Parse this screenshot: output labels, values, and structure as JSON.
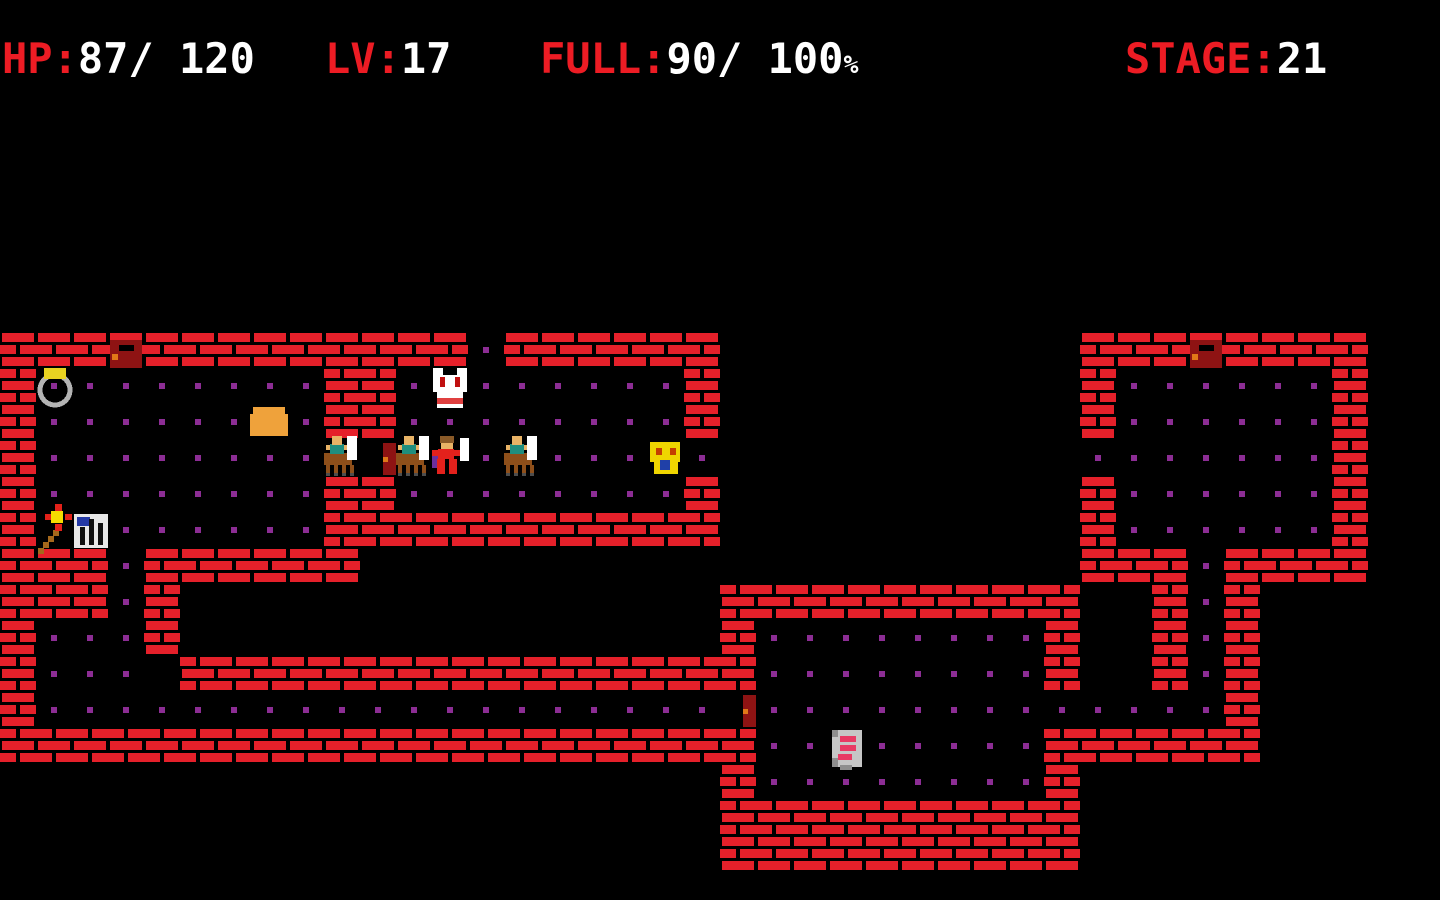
{
  "hud": {
    "hp": {
      "label": "HP:",
      "value": "87/ 120"
    },
    "lv": {
      "label": "LV:",
      "value": "17"
    },
    "full": {
      "label": "FULL:",
      "value": "90/ 100",
      "unit": "%"
    },
    "stage": {
      "label": "STAGE:",
      "value": "21"
    }
  },
  "palette": {
    "black": "#000000",
    "brick": "#E5202A",
    "dot": "#8C2D94",
    "doorDark": "#8E1313",
    "doorKeyhole": "#E07818",
    "skin": "#E8B366",
    "teal": "#1F8E7E",
    "horse": "#8E4F1A",
    "hoof": "#4D4D4D",
    "white": "#FFFFFF",
    "red2": "#E3211C",
    "cape": "#6C2E9E",
    "hair": "#8A5A28",
    "maskEye": "#C01010",
    "maskMouth": "#E04040",
    "faceYellow": "#EFD500",
    "faceEye": "#C43E00",
    "faceMouth": "#2040A8",
    "bread": "#EFA23B",
    "ringGray": "#B4B4B4",
    "ringGem": "#E8D221",
    "wandShaft": "#A5681C",
    "spark": "#E32119",
    "sparkCore": "#F5DC00",
    "cageWhite": "#E8E8E8",
    "cageBlue": "#2439A6",
    "cageBar": "#101010",
    "scrollGray": "#C6C6C6",
    "scrollShade": "#8E8E8E",
    "scrollText": "#E83A64",
    "hudRed": "#ED1C24",
    "hudWhite": "#FFFFFF"
  },
  "map": {
    "tile_size": 36,
    "origin_x": 0,
    "origin_y": 332,
    "cols": 40,
    "rows": 15,
    "legend": {
      "#": "brick-wall",
      ".": "floor-with-dot",
      ",": "floor-plain",
      " ": "void"
    },
    "tiles": [
      "#############.######          ########  ",
      "#........##.,......#          #......#  ",
      "#......,.##........#          #......#  ",
      "#........,,,,.,...,.          .......#  ",
      "#........##........#          #......#  ",
      "#,,......###########          #......#  ",
      "###.######                    ###.####  ",
      "###.#               ##########  #.#     ",
      "#...#               #........#  #.#     ",
      "#... ################........#  #.#     ",
      "#...................,.............#     ",
      "#####################..,.....######     ",
      "                    #........#          ",
      "                    ##########          ",
      "                    ##########          "
    ],
    "entities": [
      {
        "name": "door-front",
        "col": 3,
        "row": 0
      },
      {
        "name": "door-front",
        "col": 33,
        "row": 0
      },
      {
        "name": "ring",
        "col": 1,
        "row": 1
      },
      {
        "name": "mask",
        "col": 12,
        "row": 1
      },
      {
        "name": "bread",
        "col": 7,
        "row": 2
      },
      {
        "name": "centaur",
        "col": 9,
        "row": 3
      },
      {
        "name": "door-side",
        "col": 10,
        "row": 3
      },
      {
        "name": "centaur",
        "col": 11,
        "row": 3
      },
      {
        "name": "player",
        "col": 12,
        "row": 3
      },
      {
        "name": "centaur",
        "col": 14,
        "row": 3
      },
      {
        "name": "scared-face",
        "col": 18,
        "row": 3
      },
      {
        "name": "wand",
        "col": 1,
        "row": 5
      },
      {
        "name": "cage",
        "col": 2,
        "row": 5
      },
      {
        "name": "door-side",
        "col": 20,
        "row": 10
      },
      {
        "name": "scroll",
        "col": 23,
        "row": 11
      }
    ]
  }
}
